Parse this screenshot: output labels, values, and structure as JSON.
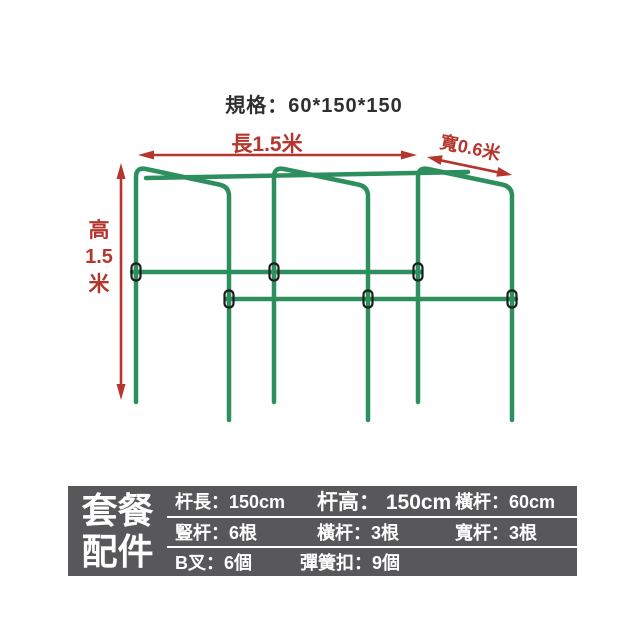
{
  "title": "規格：60*150*150",
  "colors": {
    "frame_green": "#2e8f5e",
    "dimension_red": "#b5362e",
    "clip_outline": "#1c1c1c",
    "table_bg": "#58585a",
    "table_text": "#ffffff",
    "title_text": "#2f2f2f"
  },
  "diagram": {
    "length_label": "長1.5米",
    "width_label": "寬0.6米",
    "height_label": [
      "高",
      "1.5",
      "米"
    ]
  },
  "package_table": {
    "title_lines": [
      "套餐",
      "配件"
    ],
    "rows": [
      [
        "杆長：150cm",
        "杆高： 150cm",
        "橫杆：60cm"
      ],
      [
        "豎杆：6根",
        "橫杆：3根",
        "寬杆：3根"
      ],
      [
        "B叉：6個",
        "彈簧扣：9個"
      ]
    ]
  }
}
